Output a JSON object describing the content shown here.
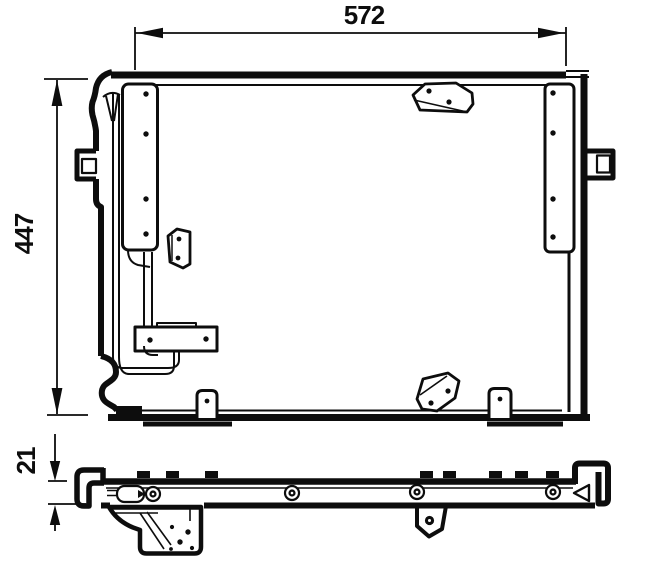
{
  "drawing": {
    "background": "#ffffff",
    "ink": "#0d0d0d",
    "views": {
      "front": {
        "name": "front-view",
        "dim_width_label": "572",
        "dim_height_label": "447"
      },
      "profile": {
        "name": "bottom-profile-view",
        "dim_thickness_label": "21"
      }
    }
  }
}
